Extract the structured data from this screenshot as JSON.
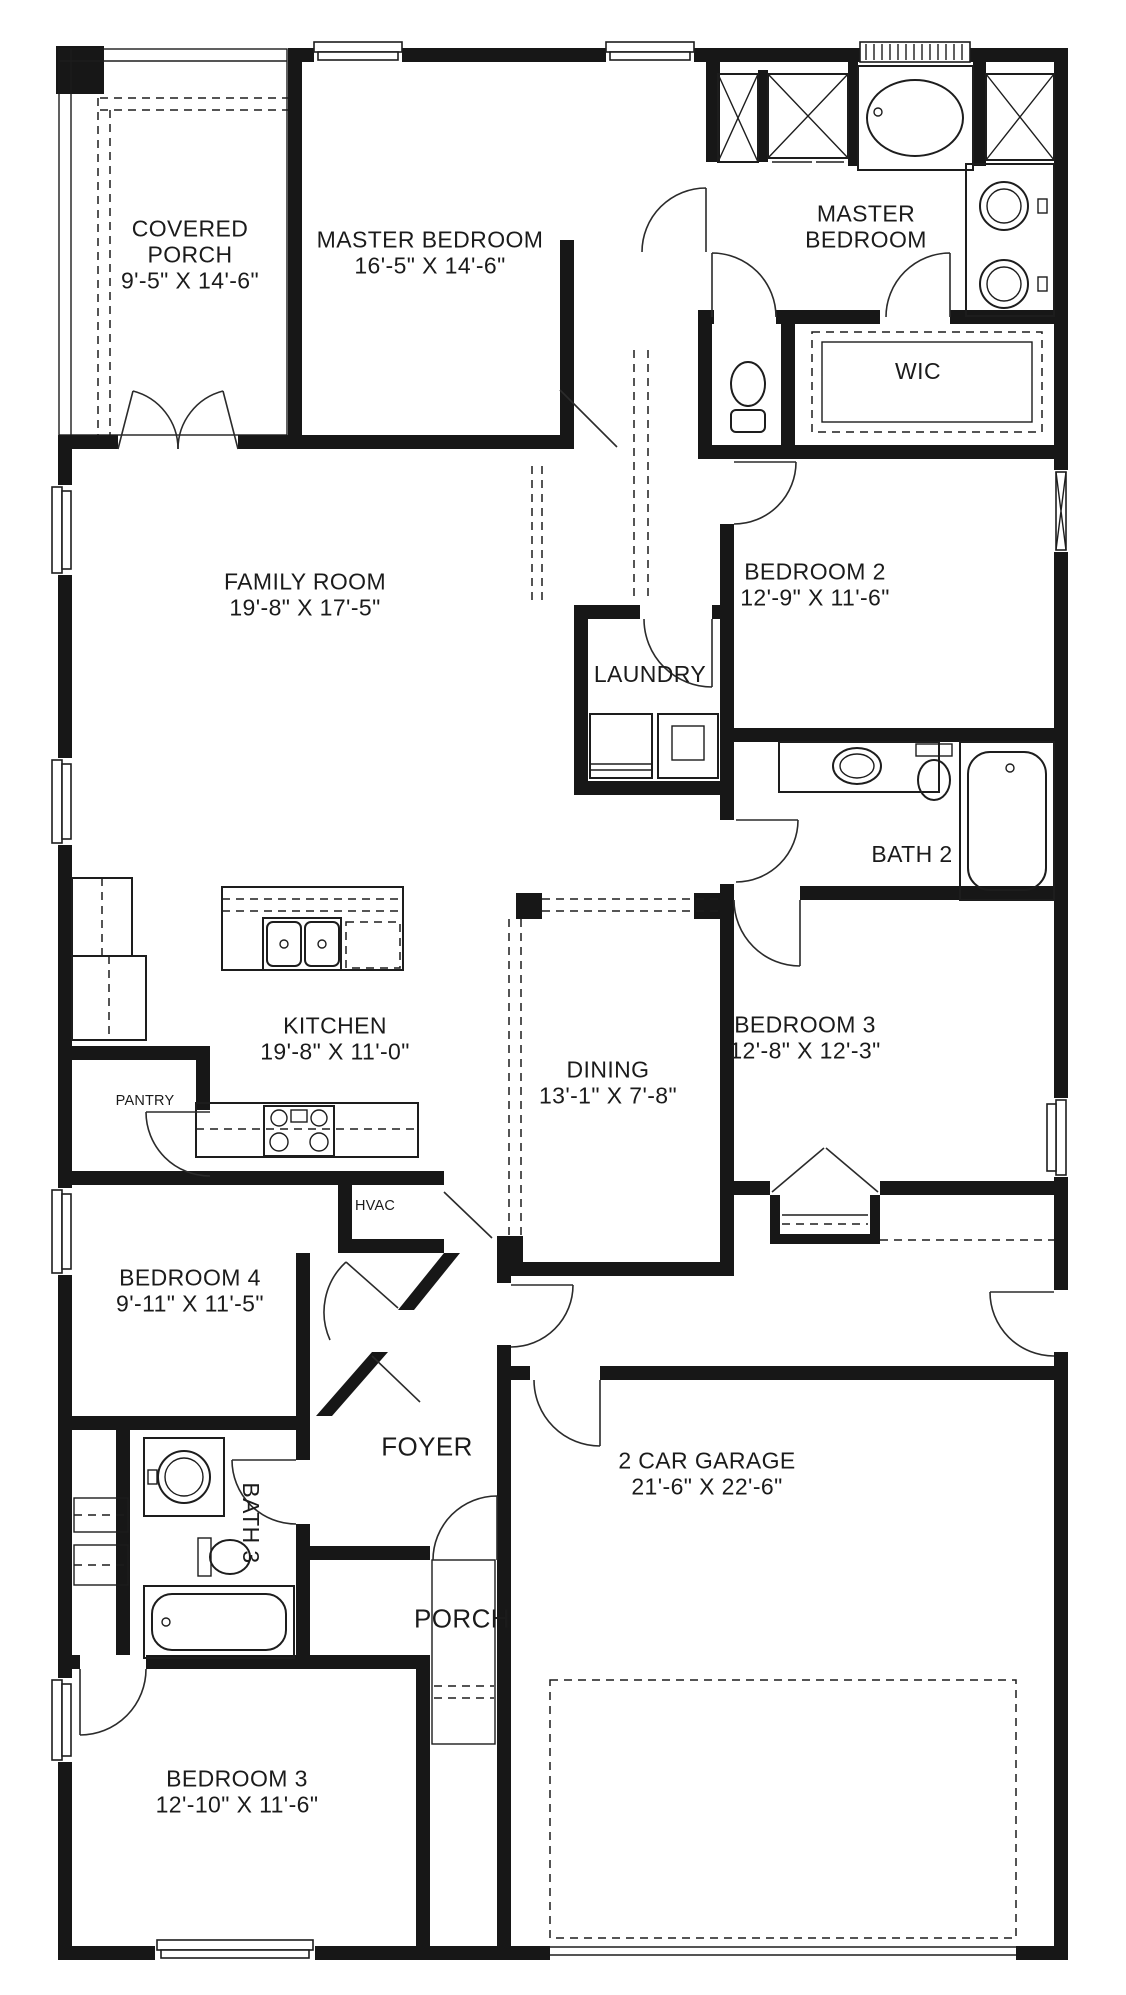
{
  "plan": {
    "colors": {
      "wall": "#171717",
      "background": "#ffffff",
      "line": "#1d1d1d"
    },
    "rooms": [
      {
        "id": "covered_porch",
        "name": "COVERED PORCH",
        "dims": "9'-5\" X 14'-6\""
      },
      {
        "id": "master_bedroom",
        "name": "MASTER BEDROOM",
        "dims": "16'-5\" X 14'-6\""
      },
      {
        "id": "master_bath",
        "name": "MASTER BEDROOM",
        "dims": ""
      },
      {
        "id": "wic",
        "name": "WIC",
        "dims": ""
      },
      {
        "id": "family_room",
        "name": "FAMILY ROOM",
        "dims": "19'-8\" X 17'-5\""
      },
      {
        "id": "bedroom_2",
        "name": "BEDROOM 2",
        "dims": "12'-9\" X 11'-6\""
      },
      {
        "id": "laundry",
        "name": "LAUNDRY",
        "dims": ""
      },
      {
        "id": "bath_2",
        "name": "BATH 2",
        "dims": ""
      },
      {
        "id": "kitchen",
        "name": "KITCHEN",
        "dims": "19'-8\" X 11'-0\""
      },
      {
        "id": "pantry",
        "name": "PANTRY",
        "dims": ""
      },
      {
        "id": "dining",
        "name": "DINING",
        "dims": "13'-1\" X 7'-8\""
      },
      {
        "id": "bedroom_3_mid",
        "name": "BEDROOM 3",
        "dims": "12'-8\" X 12'-3\""
      },
      {
        "id": "hvac",
        "name": "HVAC",
        "dims": ""
      },
      {
        "id": "bedroom_4",
        "name": "BEDROOM 4",
        "dims": "9'-11\" X 11'-5\""
      },
      {
        "id": "foyer",
        "name": "FOYER",
        "dims": ""
      },
      {
        "id": "bath_3",
        "name": "BATH 3",
        "dims": ""
      },
      {
        "id": "porch",
        "name": "PORCH",
        "dims": ""
      },
      {
        "id": "garage",
        "name": "2 CAR GARAGE",
        "dims": "21'-6\" X 22'-6\""
      },
      {
        "id": "bedroom_3_front",
        "name": "BEDROOM 3",
        "dims": "12'-10\" X 11'-6\""
      }
    ]
  }
}
